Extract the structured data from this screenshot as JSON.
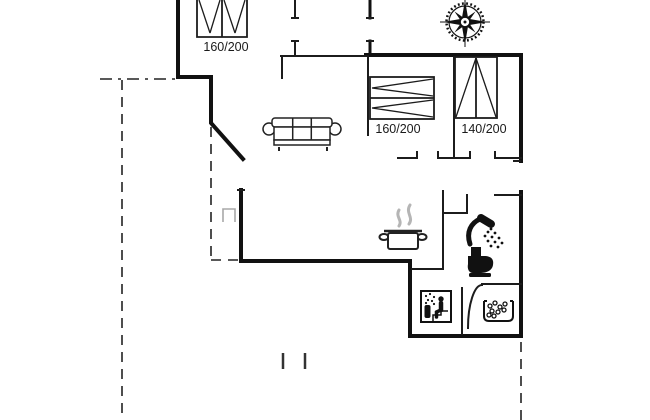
{
  "floor_plan": {
    "type": "vacation-house-floor-plan",
    "bed_labels": [
      {
        "id": "bed-top-left",
        "label": "160/200"
      },
      {
        "id": "bed-middle",
        "label": "160/200"
      },
      {
        "id": "bed-right",
        "label": "140/200"
      }
    ],
    "symbols": [
      "compass-rose",
      "double-bed",
      "double-bed",
      "double-bed",
      "sofa",
      "cooking-pot-with-steam",
      "shower",
      "toilet",
      "sauna",
      "whirlpool-tub",
      "terrace-dashed-outline"
    ],
    "colors": {
      "walls": "#111111",
      "lines": "#1c1c1c",
      "steam": "#b5b5b5",
      "terrace_marker": "#a8a8a8",
      "background": "#ffffff"
    }
  }
}
